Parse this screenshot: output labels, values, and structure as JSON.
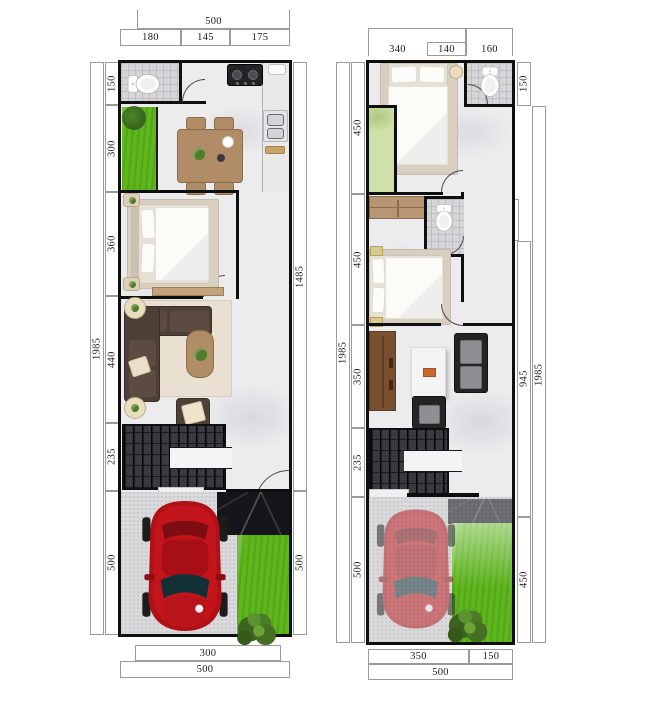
{
  "colors": {
    "wall": "#0f0f10",
    "marble_floor": "#ececee",
    "bath_tile": "#d6d6d8",
    "grass_green": "#5eb51c",
    "pale_green": "#cfe0a8",
    "stairs_dark": "#35373c",
    "concrete": "#dadadc",
    "black_marble": "#15161a",
    "wood": "#b08d66",
    "dark_wood": "#7a4f30",
    "sofa_brown": "#4e4037",
    "sofa_black": "#242424",
    "car_red": "#b01116",
    "rug_cream": "#e9e0d2",
    "accent_orange": "#c96a2e"
  },
  "plans": [
    {
      "id": "ground-floor",
      "dims": {
        "top_overall": "500",
        "top_segments": [
          "180",
          "145",
          "175"
        ],
        "left_overall": "1985",
        "left_segments": [
          "150",
          "300",
          "360",
          "440",
          "235",
          "500"
        ],
        "right_segments": [
          "1485",
          "500"
        ],
        "bottom_inner": "300",
        "bottom_overall": "500"
      }
    },
    {
      "id": "upper-floor",
      "dims": {
        "top_segments": [
          "340",
          "140",
          "160"
        ],
        "left_overall": "1985",
        "left_segments": [
          "450",
          "450",
          "350",
          "235",
          "500"
        ],
        "right_overall": "1985",
        "right_segments": [
          "150",
          "140",
          "945",
          "450"
        ],
        "bottom_segments": [
          "350",
          "150"
        ],
        "bottom_overall": "500"
      }
    }
  ]
}
